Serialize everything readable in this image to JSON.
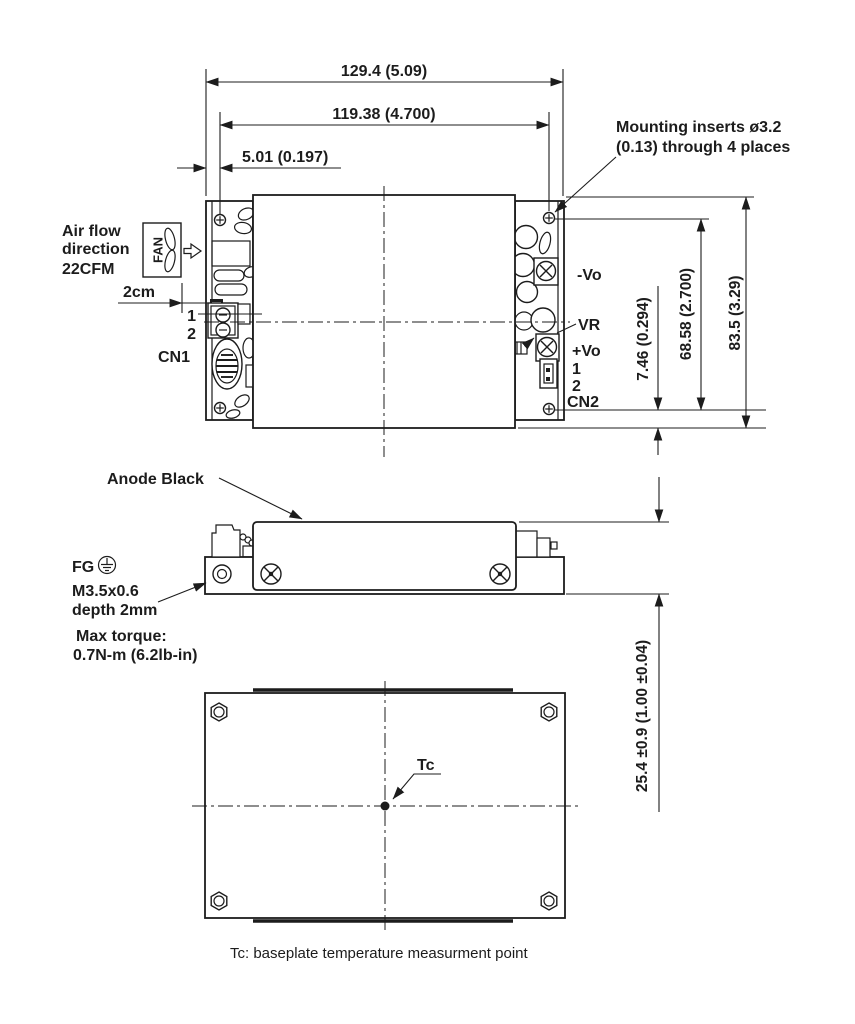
{
  "colors": {
    "background": "#ffffff",
    "line": "#1c1c1c"
  },
  "top_view": {
    "dim_overall_width": "129.4 (5.09)",
    "dim_hole_spacing_h": "119.38 (4.700)",
    "dim_edge_to_hole": "5.01 (0.197)",
    "mounting_note_line1": "Mounting inserts ø3.2",
    "mounting_note_line2": "(0.13) through 4 places",
    "airflow_line1": "Air flow",
    "airflow_line2": "direction",
    "airflow_line3": "22CFM",
    "fan_label": "FAN",
    "fan_clearance": "2cm",
    "cn1_pin1": "1",
    "cn1_pin2": "2",
    "cn1_label": "CN1",
    "neg_vo_label": "-Vo",
    "vr_label": "VR",
    "pos_vo_label": "+Vo",
    "cn2_pin1": "1",
    "cn2_pin2": "2",
    "cn2_label": "CN2",
    "dim_hole_to_edge_v": "7.46 (0.294)",
    "dim_hole_spacing_v": "68.58 (2.700)",
    "dim_overall_depth": "83.5 (3.29)"
  },
  "side_view": {
    "anode_label": "Anode Black",
    "fg_label": "FG",
    "thread_line1": "M3.5x0.6",
    "thread_line2": "depth 2mm",
    "torque_line1": "Max torque:",
    "torque_line2": "0.7N-m (6.2lb-in)",
    "dim_overall_height": "25.4 ±0.9 (1.00 ±0.04)"
  },
  "bottom_view": {
    "tc_label": "Tc",
    "caption": "Tc: baseplate temperature measurment point"
  }
}
